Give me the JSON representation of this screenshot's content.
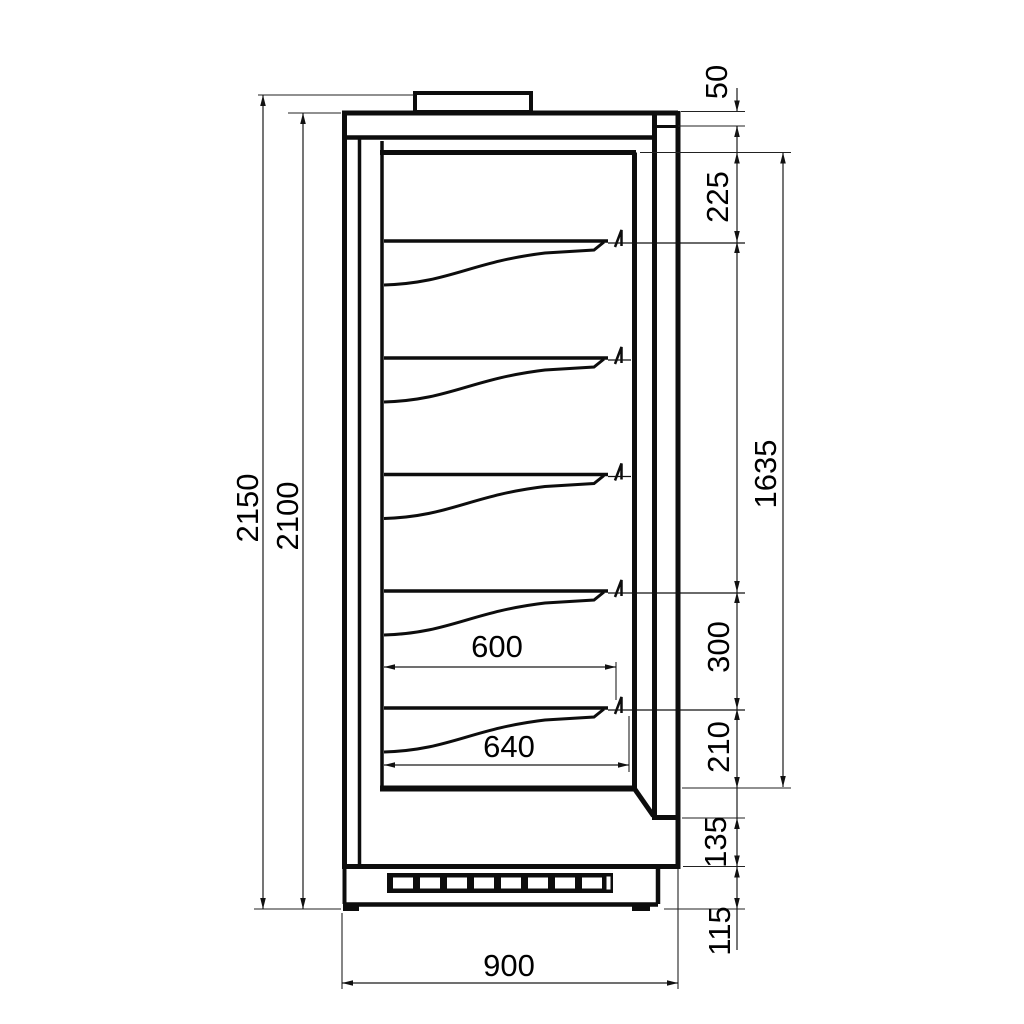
{
  "drawing": {
    "kind": "technical-drawing-side-section",
    "subject": "refrigerated display cabinet with five shelves",
    "units": "mm",
    "dimensions": {
      "overall_height": "2150",
      "cabinet_height": "2100",
      "top_edge": "50",
      "top_to_first_shelf": "225",
      "shelf_zone_height": "1635",
      "shelf_pitch": "300",
      "last_shelf_to_bottom": "210",
      "bottom_front_panel": "135",
      "plinth_height": "115",
      "shelf_depth": "600",
      "interior_depth": "640",
      "overall_depth": "900"
    }
  }
}
